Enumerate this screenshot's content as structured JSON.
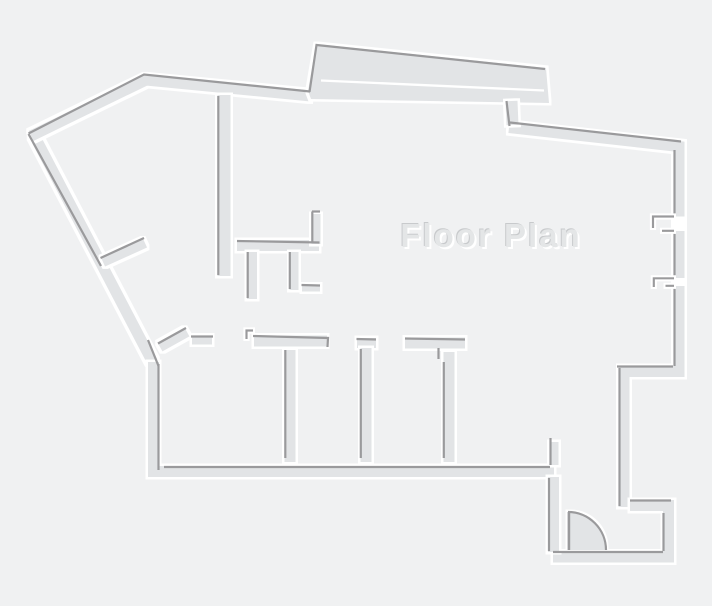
{
  "title": {
    "text": "Floor Plan"
  },
  "palette": {
    "background": "#f0f1f2",
    "wall": "#e2e4e6",
    "wall_edge": "#9a9a9c",
    "highlight": "#ffffff",
    "title_fill": "#e4e6e7",
    "title_shadow_dark": "#c8cacc"
  }
}
